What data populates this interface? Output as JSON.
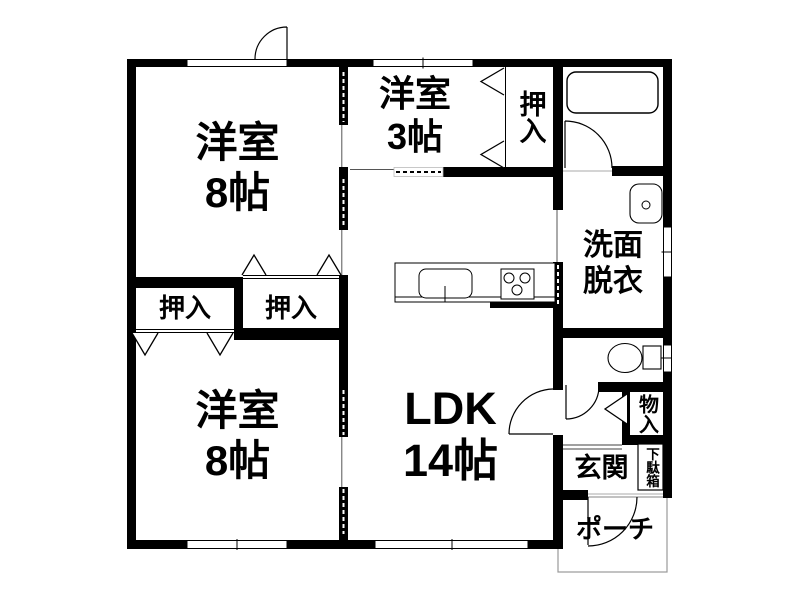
{
  "floorplan": {
    "colors": {
      "wall": "#000000",
      "background": "#ffffff",
      "thin_line": "#999999"
    },
    "rooms": {
      "western_room_top": {
        "label": "洋室\n8帖"
      },
      "western_room_small": {
        "label": "洋室\n3帖"
      },
      "closet_upper_right": {
        "label": "押入"
      },
      "washroom": {
        "label": "洗面\n脱衣"
      },
      "closet_mid_left": {
        "label": "押入"
      },
      "closet_mid_right": {
        "label": "押入"
      },
      "western_room_bottom": {
        "label": "洋室\n8帖"
      },
      "ldk": {
        "label": "LDK\n14帖"
      },
      "storage": {
        "label": "物入"
      },
      "entrance": {
        "label": "玄関"
      },
      "shoe_cabinet": {
        "label": "下駄箱"
      },
      "porch": {
        "label": "ポーチ"
      }
    },
    "fixtures": [
      "bathtub-icon",
      "washbasin-icon",
      "toilet-icon",
      "kitchen-sink-icon",
      "stove-icon"
    ]
  }
}
